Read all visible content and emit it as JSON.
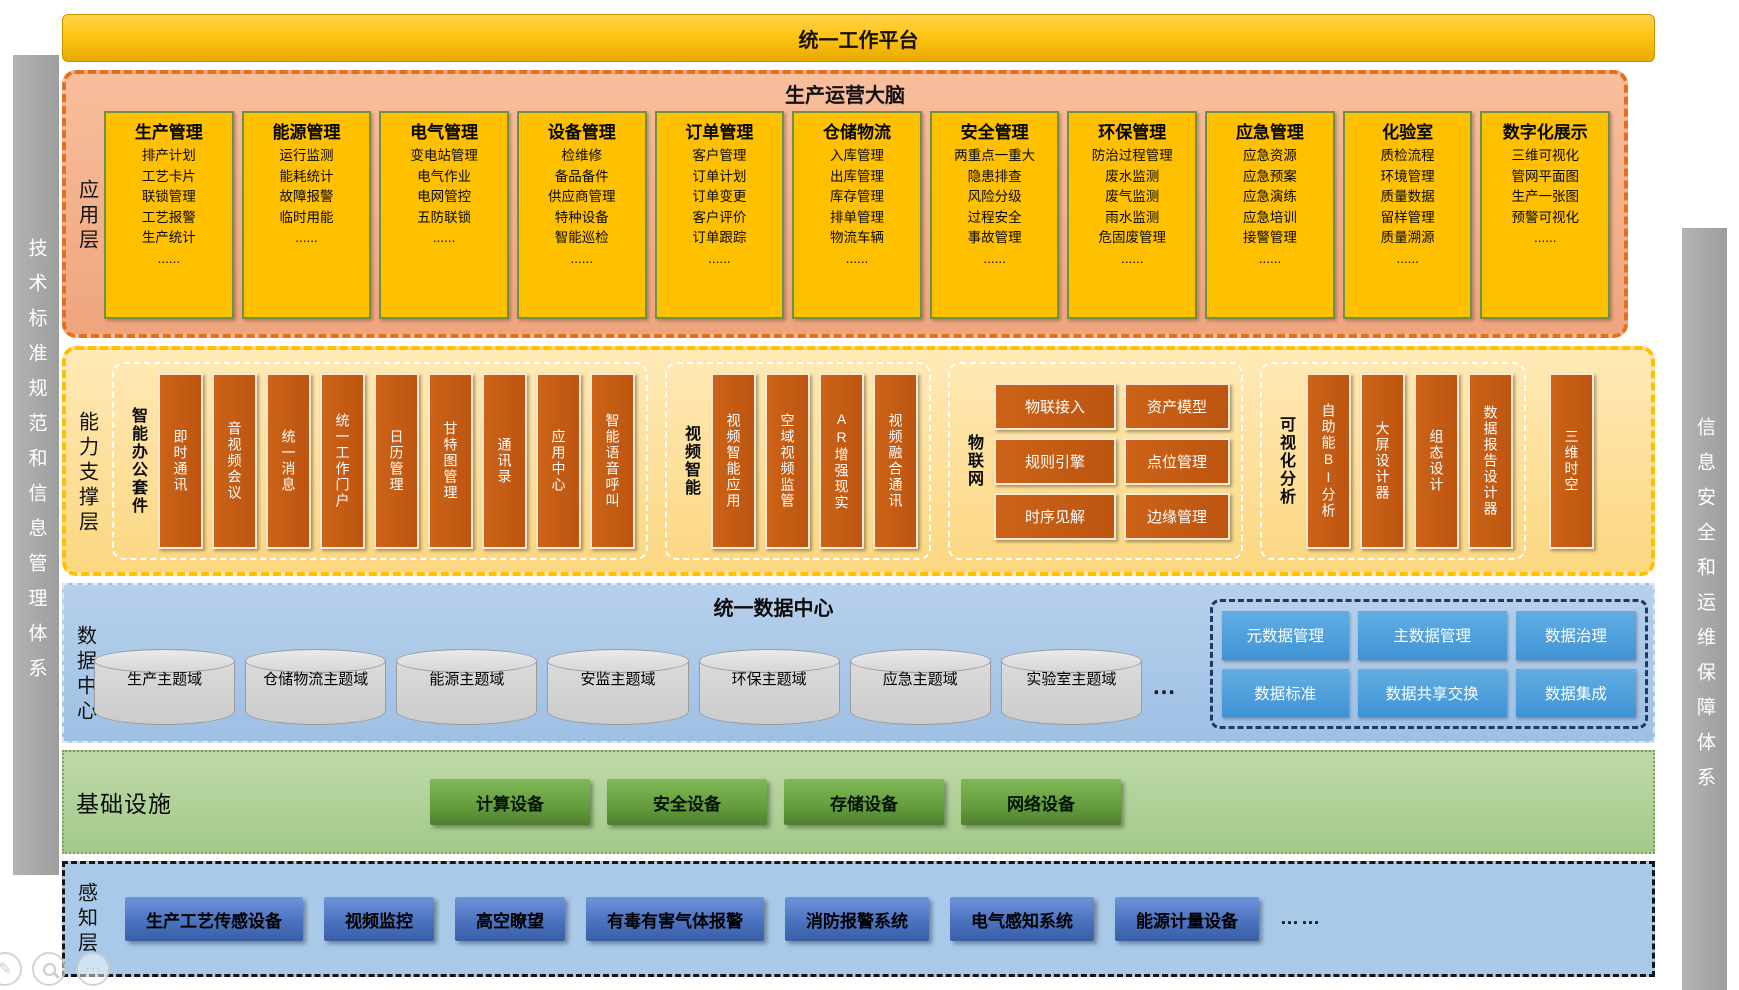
{
  "palette": {
    "gold": "#FFC000",
    "app_bg": "#F2AE86",
    "app_border": "#E4701E",
    "box_green_border": "#6E9049",
    "brown_bar": "#C55A11",
    "data_bg": "#A9C8E8",
    "governance_blue": "#459BD7",
    "governance_border": "#1F3864",
    "infra_bg": "#AFD195",
    "infra_button": "#5E9140",
    "percept_button": "#4A76C4",
    "pillar_gray": "#A6A6A6"
  },
  "top_bar": {
    "title": "统一工作平台"
  },
  "left_pillar": {
    "label": "技术标准规范和信息管理体系"
  },
  "right_pillar": {
    "label": "信息安全和运维保障体系"
  },
  "app_layer": {
    "title": "生产运营大脑",
    "side_label": "应用层",
    "boxes": [
      {
        "title": "生产管理",
        "items": [
          "排产计划",
          "工艺卡片",
          "联锁管理",
          "工艺报警",
          "生产统计",
          "......"
        ]
      },
      {
        "title": "能源管理",
        "items": [
          "运行监测",
          "能耗统计",
          "故障报警",
          "临时用能",
          "......"
        ]
      },
      {
        "title": "电气管理",
        "items": [
          "变电站管理",
          "电气作业",
          "电网管控",
          "五防联锁",
          "......"
        ]
      },
      {
        "title": "设备管理",
        "items": [
          "检维修",
          "备品备件",
          "供应商管理",
          "特种设备",
          "智能巡检",
          "......"
        ]
      },
      {
        "title": "订单管理",
        "items": [
          "客户管理",
          "订单计划",
          "订单变更",
          "客户评价",
          "订单跟踪",
          "......"
        ]
      },
      {
        "title": "仓储物流",
        "items": [
          "入库管理",
          "出库管理",
          "库存管理",
          "排单管理",
          "物流车辆",
          "......"
        ]
      },
      {
        "title": "安全管理",
        "items": [
          "两重点一重大",
          "隐患排查",
          "风险分级",
          "过程安全",
          "事故管理",
          "......"
        ]
      },
      {
        "title": "环保管理",
        "items": [
          "防治过程管理",
          "废水监测",
          "废气监测",
          "雨水监测",
          "危固废管理",
          "......"
        ]
      },
      {
        "title": "应急管理",
        "items": [
          "应急资源",
          "应急预案",
          "应急演练",
          "应急培训",
          "接警管理",
          "......"
        ]
      },
      {
        "title": "化验室",
        "items": [
          "质检流程",
          "环境管理",
          "质量数据",
          "留样管理",
          "质量溯源",
          "......"
        ]
      },
      {
        "title": "数字化展示",
        "items": [
          "三维可视化",
          "管网平面图",
          "生产一张图",
          "预警可视化",
          "......"
        ]
      }
    ]
  },
  "capability_layer": {
    "side_label": "能力支撑层",
    "groups": [
      {
        "label": "智能办公套件",
        "bars": [
          "即时通讯",
          "音视频会议",
          "统一消息",
          "统一工作门户",
          "日历管理",
          "甘特图管理",
          "通讯录",
          "应用中心",
          "智能语音呼叫"
        ]
      },
      {
        "label": "视频智能",
        "bars": [
          "视频智能应用",
          "空域视频监管",
          "AR增强现实",
          "视频融合通讯"
        ]
      },
      {
        "label": "物联网",
        "cells": [
          "物联接入",
          "资产模型",
          "规则引擎",
          "点位管理",
          "时序见解",
          "边缘管理"
        ]
      },
      {
        "label": "可视化分析",
        "bars": [
          "自助能BI分析",
          "大屏设计器",
          "组态设计",
          "数据报告设计器"
        ]
      }
    ],
    "standalone_bar": "三维时空"
  },
  "data_layer": {
    "side_label": "数据中心",
    "title": "统一数据中心",
    "domains": [
      "生产主题域",
      "仓储物流主题域",
      "能源主题域",
      "安监主题域",
      "环保主题域",
      "应急主题域",
      "实验室主题域"
    ],
    "ellipsis": "…",
    "governance": [
      "元数据管理",
      "主数据管理",
      "数据治理",
      "数据标准",
      "数据共享交换",
      "数据集成"
    ]
  },
  "infra_layer": {
    "label": "基础设施",
    "devices": [
      "计算设备",
      "安全设备",
      "存储设备",
      "网络设备"
    ]
  },
  "perception_layer": {
    "side_label": "感知层",
    "devices": [
      "生产工艺传感设备",
      "视频监控",
      "高空瞭望",
      "有毒有害气体报警",
      "消防报警系统",
      "电气感知系统",
      "能源计量设备"
    ],
    "ellipsis": "……"
  },
  "corner_tools": {
    "edit_glyph": "✎",
    "more_glyph": "···"
  }
}
